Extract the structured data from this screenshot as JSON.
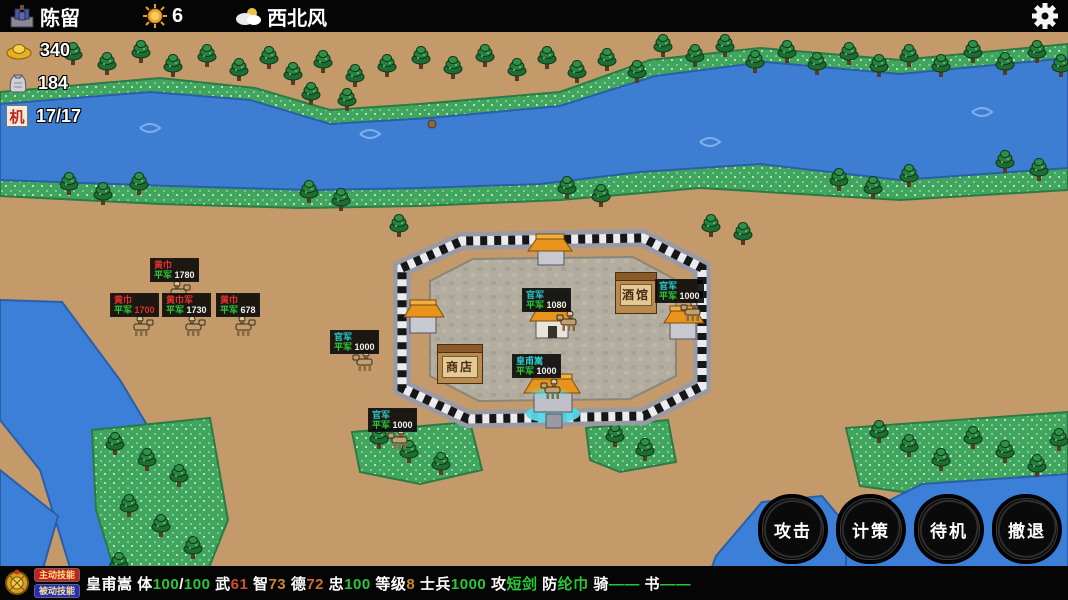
{
  "topbar": {
    "city_icon": "castle-icon",
    "city_name": "陈留",
    "sun_icon": "sun-icon",
    "day": "6",
    "weather_icon": "cloud-icon",
    "wind": "西北风",
    "gear_icon": "gear-icon"
  },
  "resources": [
    {
      "icon": "gold-ingot-icon",
      "value": "340"
    },
    {
      "icon": "rice-bag-icon",
      "value": "184"
    },
    {
      "icon": "ji-tile-icon",
      "tile_char": "机",
      "value": "17/17"
    }
  ],
  "buildings": [
    {
      "label": "商店"
    },
    {
      "label": "酒馆"
    }
  ],
  "units_style": {
    "name_colors": {
      "enemy": "#e83030",
      "ally": "#2ac8c8"
    },
    "rank_color": "#28c838",
    "selected_glow": "#50e6f0"
  },
  "units": [
    {
      "side": "enemy",
      "name": "黄巾",
      "rank": "平军",
      "count": "1780",
      "count_color": "#f0f0f0",
      "x": 150,
      "y": 258,
      "sx": 165,
      "sy": 280
    },
    {
      "side": "enemy",
      "name": "黄巾",
      "rank": "平军",
      "count": "1700",
      "count_color": "#e03030",
      "x": 110,
      "y": 293,
      "sx": 128,
      "sy": 315
    },
    {
      "side": "enemy",
      "name": "黄巾军",
      "rank": "平军",
      "count": "1730",
      "count_color": "#f0f0f0",
      "x": 162,
      "y": 293,
      "sx": 180,
      "sy": 315
    },
    {
      "side": "enemy",
      "name": "黄巾",
      "rank": "平军",
      "count": "678",
      "count_color": "#f0f0f0",
      "x": 216,
      "y": 293,
      "sx": 230,
      "sy": 315
    },
    {
      "side": "ally",
      "name": "官军",
      "rank": "平军",
      "count": "1000",
      "count_color": "#f0f0f0",
      "x": 330,
      "y": 330,
      "sx": 348,
      "sy": 350
    },
    {
      "side": "ally",
      "name": "官军",
      "rank": "平军",
      "count": "1000",
      "count_color": "#f0f0f0",
      "x": 368,
      "y": 408,
      "sx": 383,
      "sy": 428
    },
    {
      "side": "ally",
      "name": "官军",
      "rank": "平军",
      "count": "1080",
      "count_color": "#f0f0f0",
      "x": 522,
      "y": 288,
      "sx": 552,
      "sy": 310
    },
    {
      "side": "ally",
      "name": "皇甫嵩",
      "rank": "平军",
      "count": "1000",
      "count_color": "#f0f0f0",
      "x": 512,
      "y": 354,
      "sx": 536,
      "sy": 378,
      "selected": true
    },
    {
      "side": "ally",
      "name": "官军",
      "rank": "平军",
      "count": "1000",
      "count_color": "#f0f0f0",
      "x": 655,
      "y": 279,
      "sx": 676,
      "sy": 300
    }
  ],
  "action_buttons": [
    {
      "label": "攻击"
    },
    {
      "label": "计策"
    },
    {
      "label": "待机"
    },
    {
      "label": "撤退"
    }
  ],
  "bottombar": {
    "crest_icon": "general-crest-icon",
    "skills": [
      {
        "label": "主动技能",
        "color": "#c42020"
      },
      {
        "label": "被动技能",
        "color": "#2030c4"
      }
    ],
    "stats": [
      {
        "text": "皇甫嵩 ",
        "color": "#ffffff"
      },
      {
        "text": "体",
        "color": "#ffffff"
      },
      {
        "text": "100",
        "color": "#28c838"
      },
      {
        "text": "/",
        "color": "#ffffff"
      },
      {
        "text": "100",
        "color": "#28c838"
      },
      {
        "text": " 武",
        "color": "#ffffff"
      },
      {
        "text": "61",
        "color": "#cc5030"
      },
      {
        "text": " 智",
        "color": "#ffffff"
      },
      {
        "text": "73",
        "color": "#cc8828"
      },
      {
        "text": " 德",
        "color": "#ffffff"
      },
      {
        "text": "72",
        "color": "#cc7028"
      },
      {
        "text": " 忠",
        "color": "#ffffff"
      },
      {
        "text": "100",
        "color": "#28c838"
      },
      {
        "text": " 等级",
        "color": "#ffffff"
      },
      {
        "text": "8",
        "color": "#cc8828"
      },
      {
        "text": " 士兵",
        "color": "#ffffff"
      },
      {
        "text": "1000",
        "color": "#28c838"
      },
      {
        "text": " 攻",
        "color": "#ffffff"
      },
      {
        "text": "短剑",
        "color": "#28c838"
      },
      {
        "text": " 防",
        "color": "#ffffff"
      },
      {
        "text": "纶巾",
        "color": "#28c838"
      },
      {
        "text": " 骑",
        "color": "#ffffff"
      },
      {
        "text": "——",
        "color": "#28c838"
      },
      {
        "text": " 书",
        "color": "#ffffff"
      },
      {
        "text": "——",
        "color": "#28c838"
      }
    ]
  }
}
